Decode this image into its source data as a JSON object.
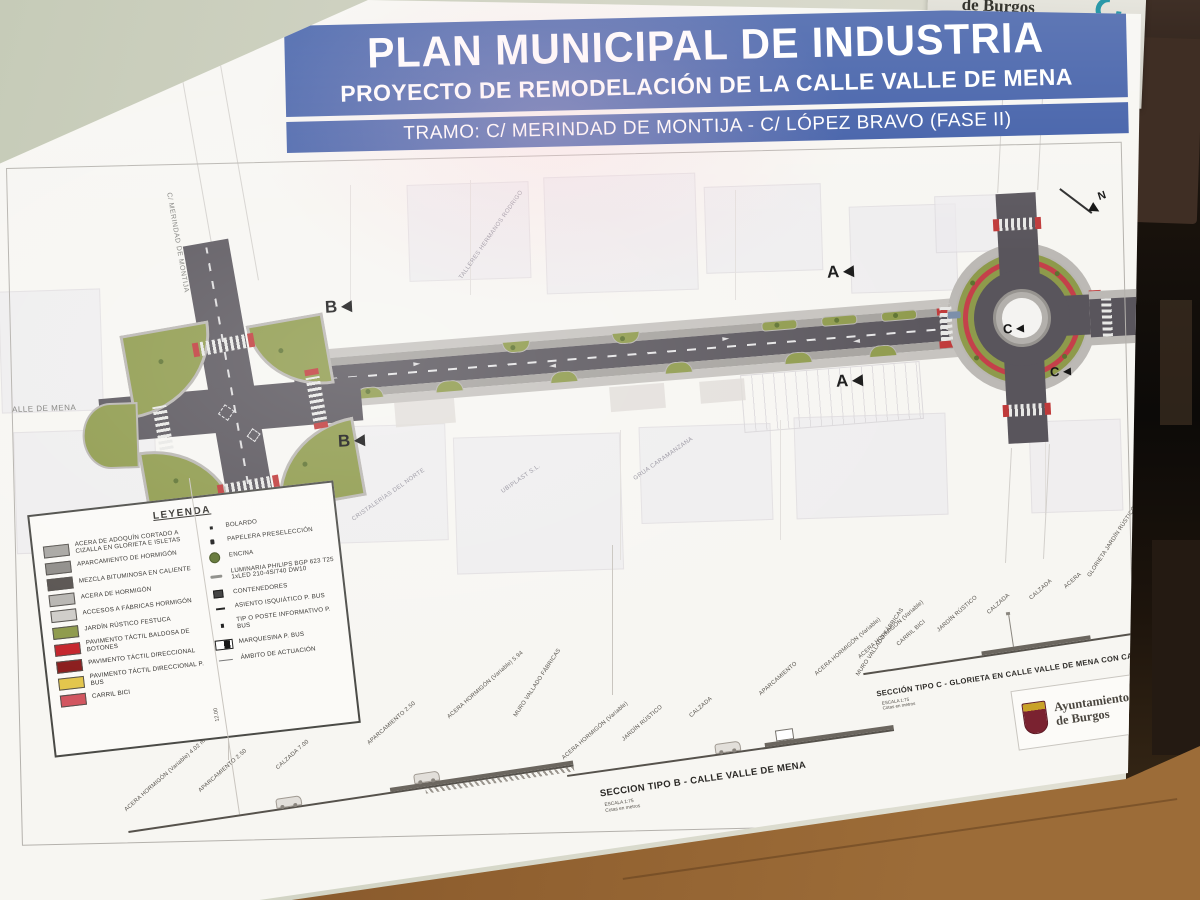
{
  "scene": {
    "backdrop_poster": {
      "title": "de Burgos",
      "url": "www.aytoburgos.es",
      "logo_line1": "BUR",
      "logo_line2": "GOS"
    }
  },
  "titlebar": {
    "line1": "PLAN MUNICIPAL DE INDUSTRIA",
    "line2": "PROYECTO DE REMODELACIÓN DE LA CALLE VALLE DE MENA",
    "line3": "TRAMO: C/ MERINDAD DE MONTIJA - C/ LÓPEZ BRAVO (FASE II)",
    "bg_color": "#3d5ba6"
  },
  "plan": {
    "street_label_left": "ALLE DE MENA",
    "street_label_vertical": "C/ MERINDAD DE MONTIJA",
    "north_label": "N",
    "markers": {
      "a": "A",
      "b": "B",
      "c": "C"
    },
    "building_labels": [
      "TALLERES HERMANOS RODRIGO",
      "CRISTALERÍAS DEL NORTE",
      "UBIPLAST S.L.",
      "GRUA CARAMANZANA"
    ],
    "colors": {
      "asphalt": "#59555c",
      "sidewalk": "#c6c3bf",
      "parking": "#a5a29e",
      "garden": "#8e9a4b",
      "tactile_red": "#c03a3a",
      "bici_red": "#c4404a"
    }
  },
  "legend": {
    "title": "LEYENDA",
    "swatches": [
      {
        "label": "ACERA DE ADOQUÍN CORTADO A CIZALLA EN GLORIETA E ISLETAS",
        "color": "#a8a6a2"
      },
      {
        "label": "APARCAMIENTO DE HORMIGÓN",
        "color": "#8f8d89"
      },
      {
        "label": "MEZCLA BITUMINOSA EN CALIENTE",
        "color": "#57524f"
      },
      {
        "label": "ACERA DE HORMIGÓN",
        "color": "#b8b6b2"
      },
      {
        "label": "ACCESOS A FÁBRICAS HORMIGÓN",
        "color": "#cfcdc9"
      },
      {
        "label": "JARDÍN RÚSTICO FESTUCA",
        "color": "#8e9a4b"
      },
      {
        "label": "PAVIMENTO TÁCTIL BALDOSA DE BOTONES",
        "color": "#c5252c"
      },
      {
        "label": "PAVIMENTO TÁCTIL DIRECCIONAL",
        "color": "#8c1f1f"
      },
      {
        "label": "PAVIMENTO TÁCTIL DIRECCIONAL P. BUS",
        "color": "#e3c64d"
      },
      {
        "label": "CARRIL BICI",
        "color": "#d25660"
      }
    ],
    "symbols": [
      {
        "label": "BOLARDO",
        "glyph": "bolardo"
      },
      {
        "label": "PAPELERA PRESELECCIÓN",
        "glyph": "papelera"
      },
      {
        "label": "ENCINA",
        "glyph": "encina"
      },
      {
        "label": "LUMINARIA PHILIPS BGP 623 T25 1xLED 210-4S/740 DW10",
        "glyph": "luminaria"
      },
      {
        "label": "CONTENEDORES",
        "glyph": "contenedores"
      },
      {
        "label": "ASIENTO ISQUIÁTICO P. BUS",
        "glyph": "asiento"
      },
      {
        "label": "TIP O POSTE INFORMATIVO P. BUS",
        "glyph": "poste"
      },
      {
        "label": "MARQUESINA P. BUS",
        "glyph": "marquesina"
      },
      {
        "label": "ÁMBITO DE ACTUACIÓN",
        "glyph": "ambito"
      }
    ]
  },
  "sections": {
    "a": {
      "labels": [
        "ACERA HORMIGÓN (Variable) 4.02 m",
        "APARCAMIENTO 2.50",
        "CALZADA 7.00",
        "APARCAMIENTO 2.50",
        "ACERA HORMIGÓN (Variable) 5.94",
        "MURO VALLADO FÁBRICAS"
      ],
      "vertical_dim": "12.00"
    },
    "b": {
      "title": "SECCION TIPO B - CALLE VALLE DE MENA",
      "scale": "ESCALA 1:75",
      "scale_note": "Cotas en metros",
      "labels": [
        "ACERA HORMIGÓN (Variable)",
        "JARDÍN RÚSTICO",
        "CALZADA",
        "APARCAMIENTO",
        "ACERA HORMIGÓN (Variable)",
        "MURO VALLADO FÁBRICAS"
      ]
    },
    "c": {
      "title": "SECCIÓN TIPO C - GLORIETA EN CALLE VALLE DE MENA CON CALLE LÓPEZ BRAVO",
      "scale": "ESCALA 1:75",
      "scale_note": "Cotas en metros",
      "labels": [
        "ACERA HORMIGÓN (Variable)",
        "CARRIL BICI",
        "JARDÍN RÚSTICO",
        "CALZADA",
        "CALZADA",
        "ACERA",
        "GLORIETA JARDÍN RÚSTICO"
      ]
    }
  },
  "logo_box": {
    "line1": "Ayuntamiento",
    "line2": "de Burgos"
  }
}
